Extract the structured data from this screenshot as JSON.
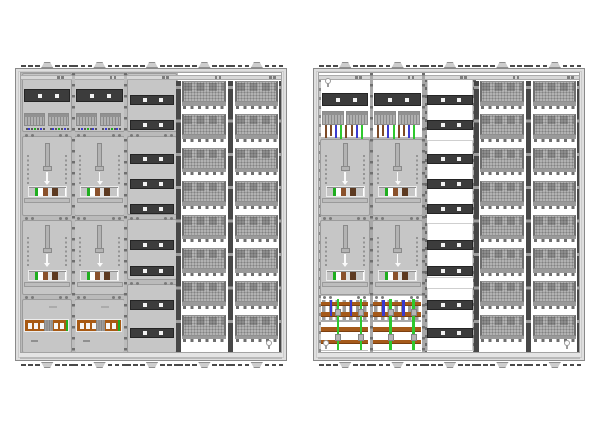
{
  "page": {
    "background": "#ffffff"
  },
  "colors": {
    "frame": "#e4e4e4",
    "frame_border": "#8a8a8a",
    "panel": "#c6c6c6",
    "panel_border": "#9b9b9b",
    "panel_backdrop": "#bababa",
    "strip_dark": "#3c3c3c",
    "strip_dot": "#f2f2f2",
    "rail_dark": "#474747",
    "perf_plate": "#b2b2b2",
    "perf_dot": "#828282",
    "comb": "#9a9a9a",
    "tooth": "#6e6e6e",
    "white": "#ffffff",
    "green": "#1fae1f",
    "bright_green": "#2ec82e",
    "blue": "#3a3ad0",
    "brown": "#7d4a26",
    "busbar_brown": "#a55a1a",
    "sls_brown": "#a85a14",
    "meter_brown": "#8a512b",
    "meter_dark_brown": "#5d3a21",
    "metal": "#b3b3b3"
  },
  "cabinets": [
    {
      "name": "meter-cabinet-left-covered",
      "variant": "covered",
      "columns": [
        {
          "type": "meter-column",
          "top": "busbar-terminals",
          "bottom": "sls-switch",
          "meters": 2
        },
        {
          "type": "meter-column",
          "top": "busbar-terminals",
          "bottom": "sls-switch",
          "meters": 2
        },
        {
          "type": "cover-column",
          "strips_per_section": [
            2,
            3,
            2,
            2
          ]
        },
        {
          "type": "grid-column",
          "rows": 8
        },
        {
          "type": "grid-column",
          "rows": 8
        }
      ],
      "keyholes": [
        "bottom-right"
      ]
    },
    {
      "name": "meter-cabinet-right-open",
      "variant": "open",
      "columns": [
        {
          "type": "meter-column",
          "top": "wired-terminals",
          "bottom": "busbar-assembly",
          "meters": 2
        },
        {
          "type": "meter-column",
          "top": "wired-terminals",
          "bottom": "busbar-assembly",
          "meters": 2
        },
        {
          "type": "rail-column",
          "strips_per_section": [
            2,
            3,
            2,
            2
          ]
        },
        {
          "type": "grid-column",
          "rows": 8
        },
        {
          "type": "grid-column",
          "rows": 8
        }
      ],
      "keyholes": [
        "top-left",
        "bottom-left",
        "bottom-right"
      ]
    }
  ],
  "wire_cycle": [
    "brown",
    "brown",
    "blue",
    "green"
  ],
  "terminal_dot_cycle": [
    "dark",
    "blue",
    "dark",
    "green"
  ],
  "meter_block_segments": [
    "metal-gray",
    "green",
    "white",
    "brown",
    "light",
    "dark-brown",
    "metal-gray"
  ]
}
